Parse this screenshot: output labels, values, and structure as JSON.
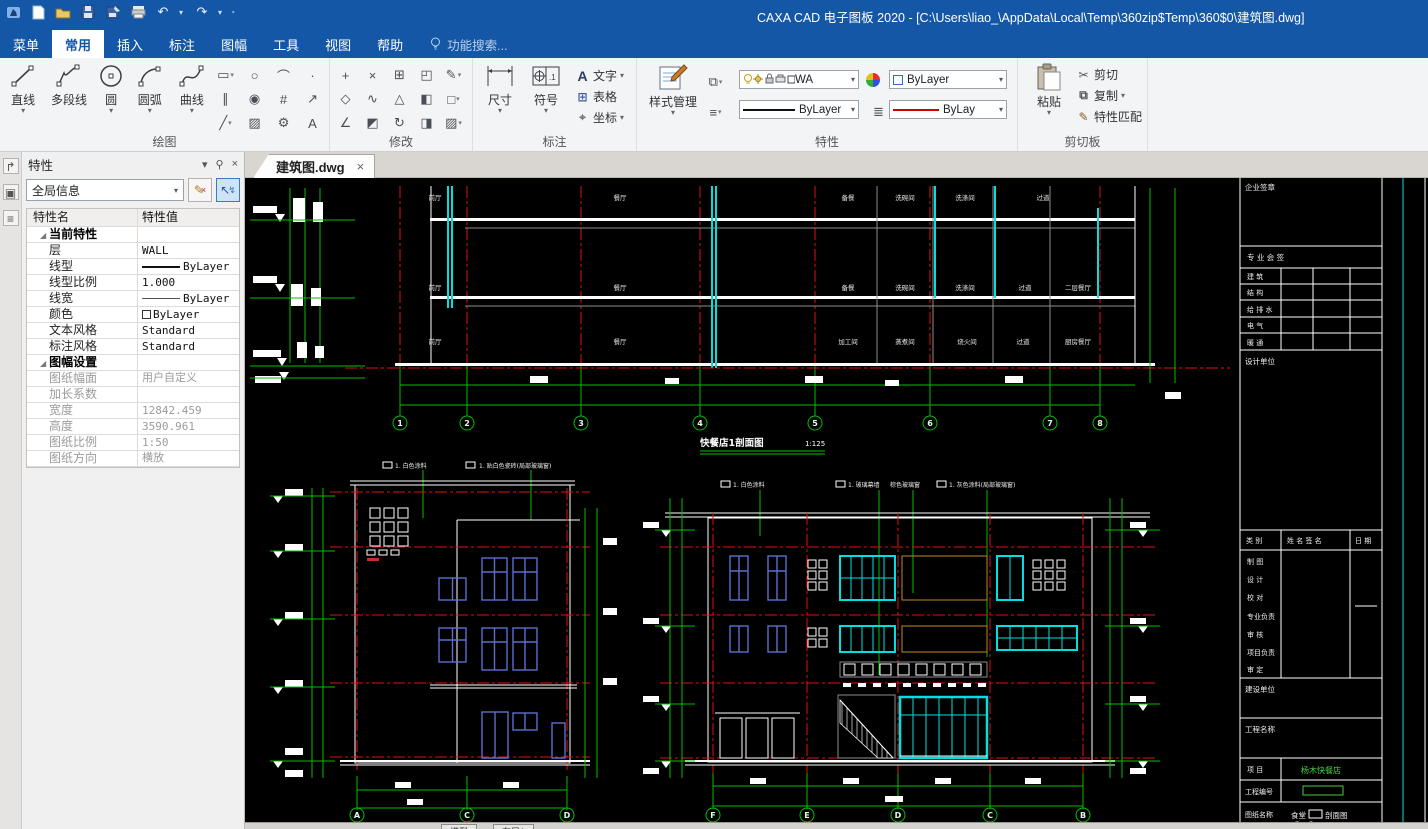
{
  "window": {
    "title": "CAXA CAD 电子图板 2020 - [C:\\Users\\liao_\\AppData\\Local\\Temp\\360zip$Temp\\360$0\\建筑图.dwg]"
  },
  "menu": {
    "tabs": [
      "菜单",
      "常用",
      "插入",
      "标注",
      "图幅",
      "工具",
      "视图",
      "帮助"
    ],
    "active": "常用",
    "search": "功能搜索..."
  },
  "ribbon": {
    "groups": {
      "draw": "绘图",
      "modify": "修改",
      "annotate": "标注",
      "properties": "特性",
      "clipboard": "剪切板"
    },
    "draw_buttons": [
      "直线",
      "多段线",
      "圆",
      "圆弧",
      "曲线"
    ],
    "annotate_big": [
      "尺寸",
      "符号"
    ],
    "annotate_small": [
      "文字",
      "表格",
      "坐标"
    ],
    "style_manager": "样式管理",
    "layer_combo": "WA",
    "color_combo": "ByLayer",
    "linetype_combo": "ByLayer",
    "linewidth_combo": "ByLay",
    "paste": "粘贴",
    "clipboard_items": [
      "剪切",
      "复制",
      "特性匹配"
    ]
  },
  "icons": {
    "caret": "▾",
    "undo": "↶",
    "redo": "↷",
    "close": "×",
    "pin": "⚲",
    "cut": "✂",
    "copy": "⧉",
    "match": "✎",
    "text_tool": "A",
    "table_tool": "⊞",
    "coord_tool": "⌖",
    "layers": "≡",
    "transfer": "⧉",
    "lineweight": "≣",
    "side": [
      "↱",
      "▣",
      "≡"
    ],
    "draw_small": [
      "▭",
      "○",
      "⌒",
      "·",
      "∥",
      "◉",
      "#",
      "↗",
      "╱",
      "▨",
      "⚙",
      "A"
    ],
    "modify": [
      "+",
      "×",
      "⊞",
      "◰",
      "✎",
      "◇",
      "∿",
      "△",
      "◧",
      "□",
      "∠",
      "◩",
      "↻",
      "◨",
      "▨"
    ]
  },
  "panel": {
    "title": "特性",
    "scope_combo": "全局信息",
    "table": {
      "col_name": "特性名",
      "col_value": "特性值",
      "rows": [
        {
          "name": "当前特性",
          "value": ""
        },
        {
          "name": "层",
          "value": "WALL"
        },
        {
          "name": "线型",
          "value": "ByLayer"
        },
        {
          "name": "线型比例",
          "value": "1.000"
        },
        {
          "name": "线宽",
          "value": "ByLayer"
        },
        {
          "name": "颜色",
          "value": "ByLayer"
        },
        {
          "name": "文本风格",
          "value": "Standard"
        },
        {
          "name": "标注风格",
          "value": "Standard"
        },
        {
          "name": "图幅设置",
          "value": ""
        },
        {
          "name": "图纸幅面",
          "value": "用户自定义"
        },
        {
          "name": "加长系数",
          "value": ""
        },
        {
          "name": "宽度",
          "value": "12842.459"
        },
        {
          "name": "高度",
          "value": "3590.961"
        },
        {
          "name": "图纸比例",
          "value": "1:50"
        },
        {
          "name": "图纸方向",
          "value": "横放"
        }
      ]
    }
  },
  "doc": {
    "tab": "建筑图.dwg",
    "model_tab": "模型",
    "layout_tab": "布局1"
  },
  "drawing": {
    "section": {
      "caption": "快餐店1剖面图",
      "scale": "1:125",
      "bubbles": [
        "1",
        "2",
        "3",
        "4",
        "5",
        "6",
        "7",
        "8"
      ],
      "rooms_f3": [
        "前厅",
        "餐厅",
        "备餐",
        "洗碗间",
        "洗涤间",
        "过道"
      ],
      "rooms_f2": [
        "前厅",
        "餐厅",
        "备餐",
        "洗碗间",
        "洗涤间",
        "过道",
        "二层餐厅"
      ],
      "rooms_f1": [
        "前厅",
        "餐厅",
        "加工间",
        "蒸煮间",
        "烧火间",
        "过道",
        "厨房餐厅"
      ]
    },
    "left_elev": {
      "bubbles": [
        "A",
        "C",
        "D"
      ],
      "notes": [
        "1. 白色涂料",
        "1. 贴白色瓷砖(局部玻璃窗)"
      ]
    },
    "right_elev": {
      "bubbles": [
        "F",
        "E",
        "D",
        "C",
        "B"
      ],
      "notes": [
        "1. 白色涂料",
        "1. 玻璃幕墙",
        "棕色玻璃窗",
        "1. 灰色涂料(局部玻璃窗)"
      ]
    }
  },
  "title_block": {
    "seal": "企业签章",
    "sign_header": "专 业 会 签",
    "disciplines": [
      "建  筑",
      "结  构",
      "给 排 水",
      "电  气",
      "暖  通"
    ],
    "design_unit": "设计单位",
    "cols": {
      "category": "类  别",
      "name_sign": "姓 名   签 名",
      "date": "日 期"
    },
    "roles": [
      "制  图",
      "设  计",
      "校  对",
      "专业负责",
      "审  核",
      "项目负责",
      "审  定"
    ],
    "build_unit": "建设单位",
    "project_name": "工程名称",
    "item_label": "项  目",
    "item_value": "杨木快餐店",
    "project_no": "工程编号",
    "sheet_label": "图纸名称",
    "sheet_pre": "食堂",
    "sheet_post": "剖面图",
    "sheet_line2": "立面图"
  },
  "colors": {
    "titlebar_blue": "#1457a6",
    "cad_green": "#00c000",
    "cad_red": "#e01010",
    "cad_cyan": "#00e0e0",
    "window_blue": "#5b6ece",
    "louver_orange": "#c08a20"
  }
}
